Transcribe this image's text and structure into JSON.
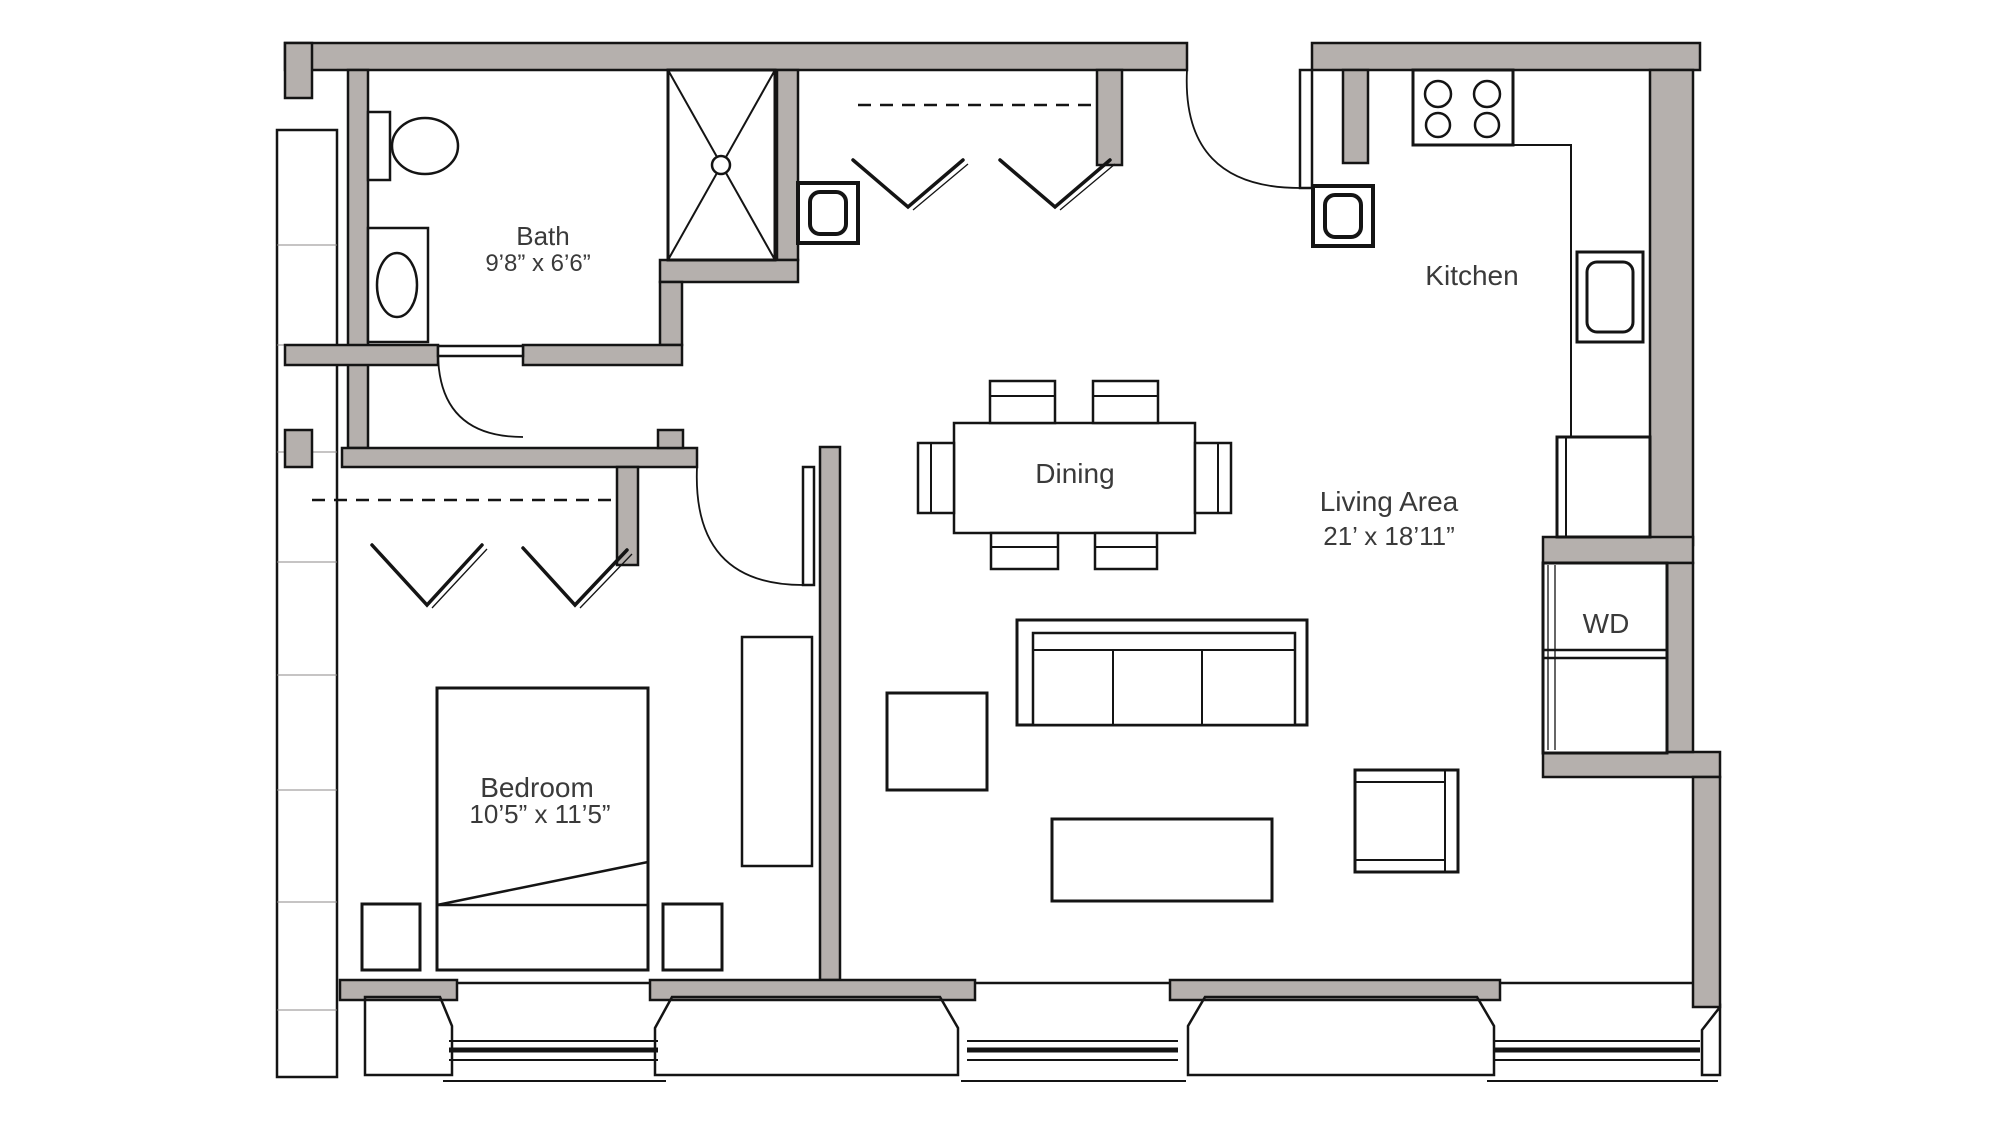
{
  "colors": {
    "wall_fill": "#b5b0ad",
    "line": "#141414",
    "text": "#3a3a3a"
  },
  "rooms": {
    "bath": {
      "name": "Bath",
      "dims": "9’8” x 6’6”"
    },
    "kitchen": {
      "name": "Kitchen"
    },
    "dining": {
      "name": "Dining"
    },
    "living": {
      "name": "Living Area",
      "dims": "21’ x 18’11”"
    },
    "bedroom": {
      "name": "Bedroom",
      "dims": "10’5” x 11’5”"
    },
    "laundry": {
      "name": "WD"
    }
  }
}
